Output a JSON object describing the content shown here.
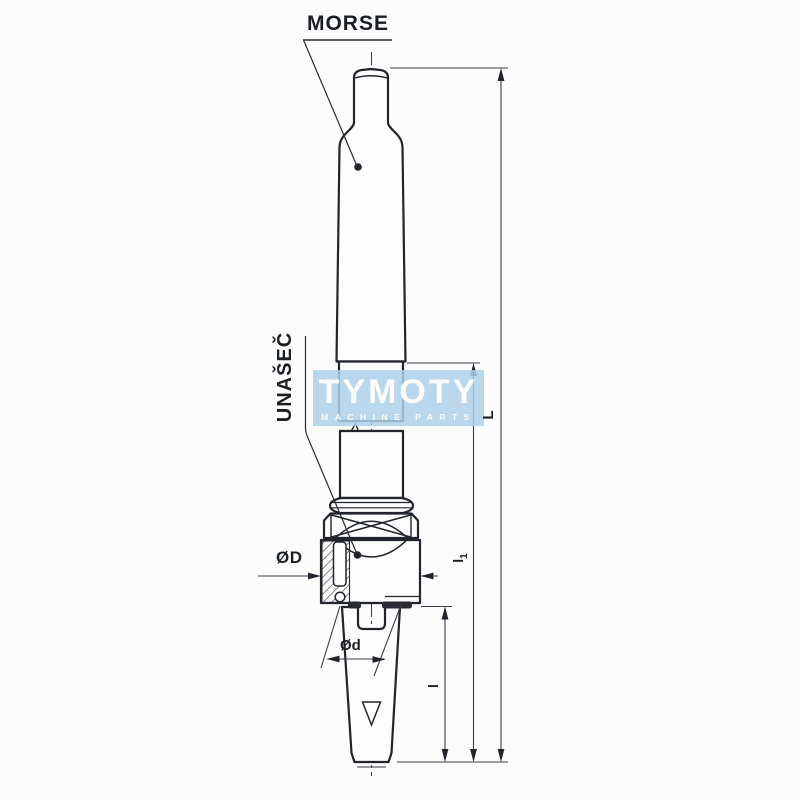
{
  "labels": {
    "morse": "MORSE",
    "unasec": "UNAŠEČ"
  },
  "dimensions": {
    "outer_diameter": "ØD",
    "pilot_diameter": "Ød",
    "total_length": "L",
    "mid_length_base": "l",
    "mid_length_sub": "1",
    "lower_length": "l"
  },
  "watermark": {
    "name": "TYMOTY",
    "tagline": "MACHINE PARTS"
  },
  "colors": {
    "background": "#fcfcfc",
    "outline": "#23232c",
    "thin_line": "#3d3d47",
    "watermark_box": "#aed0e8",
    "watermark_text": "#ffffff"
  }
}
